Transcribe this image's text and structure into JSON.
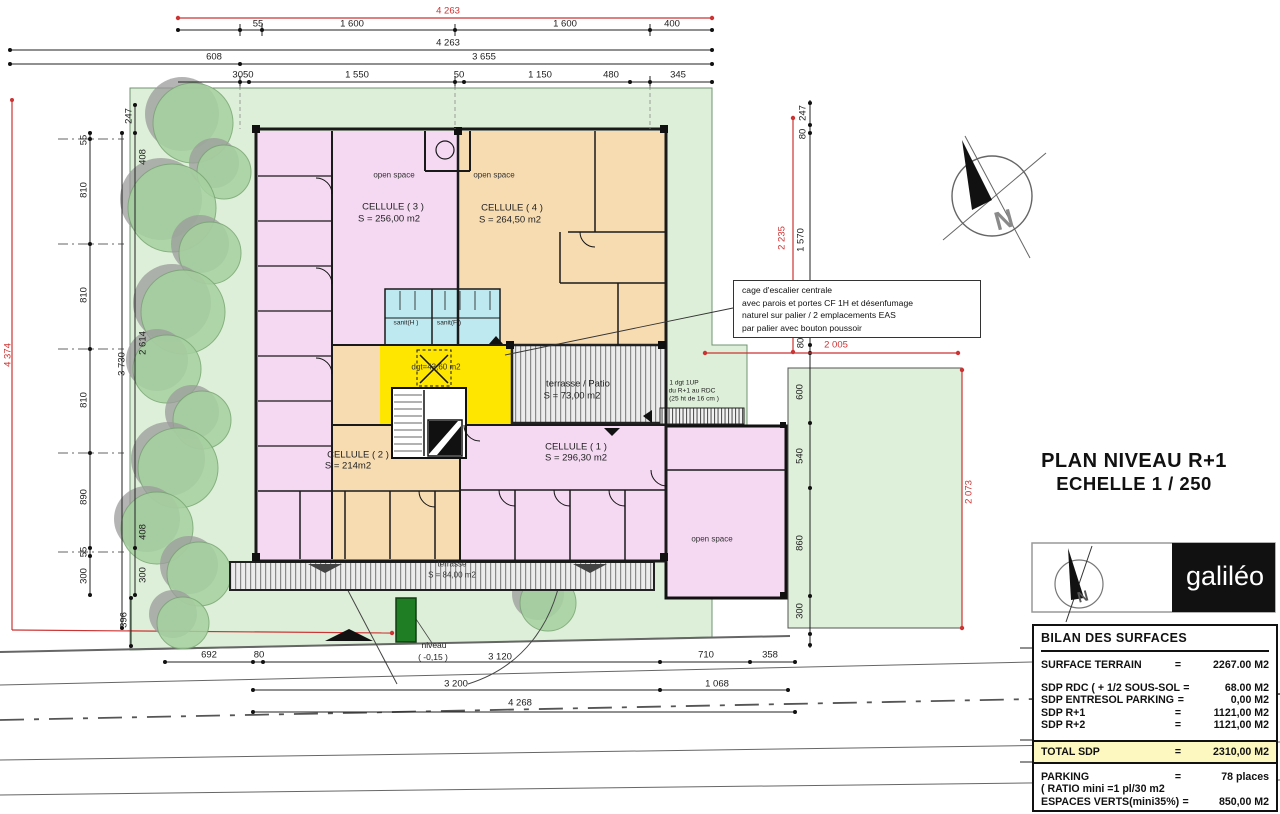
{
  "colors": {
    "accent_red": "#cc3333",
    "site_green": "#ddefd8",
    "room_pink": "#f5d9f3",
    "room_tan": "#f7dcb2",
    "room_cyan": "#bfe9f0",
    "room_yellow": "#ffe600",
    "table_total_bg": "#fcf8c0",
    "tree_green": "#a6d1a0",
    "planter_green": "#1f7d24"
  },
  "title_block": {
    "line1": "PLAN NIVEAU R+1",
    "line2": "ECHELLE  1 / 250"
  },
  "logo": {
    "brand": "galiléo"
  },
  "stair_note": {
    "lines": [
      "cage d'escalier centrale",
      "avec parois  et portes CF  1H et désenfumage",
      "naturel sur palier  / 2 emplacements EAS",
      "par palier avec bouton poussoir"
    ]
  },
  "surface_table": {
    "header": "BILAN DES SURFACES",
    "terrain": {
      "label": "SURFACE TERRAIN",
      "eq": "=",
      "value": "2267.00 M2"
    },
    "sdp_rows": [
      {
        "label": "SDP RDC ( + 1/2 SOUS-SOL",
        "eq": "=",
        "value": "68.00 M2"
      },
      {
        "label": "SDP ENTRESOL PARKING",
        "eq": "=",
        "value": "0,00 M2"
      },
      {
        "label": "SDP R+1",
        "eq": "=",
        "value": "1121,00 M2"
      },
      {
        "label": "SDP R+2",
        "eq": "=",
        "value": "1121,00 M2"
      }
    ],
    "total": {
      "label": "TOTAL SDP",
      "eq": "=",
      "value": "2310,00 M2"
    },
    "parking": {
      "label": "PARKING",
      "label2": "( RATIO mini =1 pl/30 m2",
      "eq": "=",
      "value": "78 places"
    },
    "espaces": {
      "label": "ESPACES VERTS(mini35%)",
      "eq": "=",
      "value": "850,00 M2"
    }
  },
  "labels": [
    {
      "t": "4 263",
      "x": 448,
      "y": 11,
      "c": "red",
      "n": "dim-top-total"
    },
    {
      "t": "55",
      "x": 258,
      "y": 24,
      "n": "dim"
    },
    {
      "t": "1 600",
      "x": 352,
      "y": 24,
      "n": "dim"
    },
    {
      "t": "1 600",
      "x": 565,
      "y": 24,
      "n": "dim"
    },
    {
      "t": "400",
      "x": 672,
      "y": 24,
      "n": "dim"
    },
    {
      "t": "4 263",
      "x": 448,
      "y": 43,
      "n": "dim"
    },
    {
      "t": "608",
      "x": 214,
      "y": 57,
      "n": "dim"
    },
    {
      "t": "3 655",
      "x": 484,
      "y": 57,
      "n": "dim"
    },
    {
      "t": "3050",
      "x": 243,
      "y": 75,
      "n": "dim"
    },
    {
      "t": "1 550",
      "x": 357,
      "y": 75,
      "n": "dim"
    },
    {
      "t": "50",
      "x": 459,
      "y": 75,
      "n": "dim"
    },
    {
      "t": "1 150",
      "x": 540,
      "y": 75,
      "n": "dim"
    },
    {
      "t": "480",
      "x": 611,
      "y": 75,
      "n": "dim"
    },
    {
      "t": "345",
      "x": 678,
      "y": 75,
      "n": "dim"
    },
    {
      "t": "4 374",
      "x": 8,
      "y": 355,
      "c": "red",
      "r": -90,
      "n": "dim-left-total"
    },
    {
      "t": "55",
      "x": 84,
      "y": 140,
      "r": -90,
      "n": "dim"
    },
    {
      "t": "810",
      "x": 84,
      "y": 190,
      "r": -90,
      "n": "dim"
    },
    {
      "t": "810",
      "x": 84,
      "y": 295,
      "r": -90,
      "n": "dim"
    },
    {
      "t": "810",
      "x": 84,
      "y": 400,
      "r": -90,
      "n": "dim"
    },
    {
      "t": "890",
      "x": 84,
      "y": 497,
      "r": -90,
      "n": "dim"
    },
    {
      "t": "55",
      "x": 84,
      "y": 552,
      "r": -90,
      "n": "dim"
    },
    {
      "t": "300",
      "x": 84,
      "y": 576,
      "r": -90,
      "n": "dim"
    },
    {
      "t": "247",
      "x": 129,
      "y": 116,
      "r": -90,
      "n": "dim"
    },
    {
      "t": "408",
      "x": 143,
      "y": 157,
      "r": -90,
      "n": "dim"
    },
    {
      "t": "2 614",
      "x": 143,
      "y": 343,
      "r": -90,
      "n": "dim"
    },
    {
      "t": "3 730",
      "x": 122,
      "y": 364,
      "r": -90,
      "n": "dim"
    },
    {
      "t": "408",
      "x": 143,
      "y": 532,
      "r": -90,
      "n": "dim"
    },
    {
      "t": "300",
      "x": 143,
      "y": 575,
      "r": -90,
      "n": "dim"
    },
    {
      "t": "396",
      "x": 124,
      "y": 620,
      "r": -90,
      "n": "dim"
    },
    {
      "t": "247",
      "x": 803,
      "y": 113,
      "r": -90,
      "n": "dim"
    },
    {
      "t": "80",
      "x": 803,
      "y": 134,
      "r": -90,
      "n": "dim"
    },
    {
      "t": "2 235",
      "x": 782,
      "y": 238,
      "c": "red",
      "r": -90,
      "n": "dim"
    },
    {
      "t": "1 570",
      "x": 801,
      "y": 240,
      "r": -90,
      "n": "dim"
    },
    {
      "t": "80",
      "x": 801,
      "y": 343,
      "r": -90,
      "n": "dim"
    },
    {
      "t": "2 005",
      "x": 836,
      "y": 345,
      "c": "red",
      "n": "dim"
    },
    {
      "t": "600",
      "x": 800,
      "y": 392,
      "r": -90,
      "n": "dim"
    },
    {
      "t": "540",
      "x": 800,
      "y": 456,
      "r": -90,
      "n": "dim"
    },
    {
      "t": "860",
      "x": 800,
      "y": 543,
      "r": -90,
      "n": "dim"
    },
    {
      "t": "300",
      "x": 800,
      "y": 611,
      "r": -90,
      "n": "dim"
    },
    {
      "t": "2 073",
      "x": 969,
      "y": 492,
      "c": "red",
      "r": -90,
      "n": "dim"
    },
    {
      "t": "692",
      "x": 209,
      "y": 655,
      "n": "dim"
    },
    {
      "t": "80",
      "x": 259,
      "y": 655,
      "n": "dim"
    },
    {
      "t": "niveau",
      "x": 434,
      "y": 645,
      "c": "sm",
      "n": "level-note"
    },
    {
      "t": "( -0,15 )",
      "x": 433,
      "y": 657,
      "c": "sm",
      "n": "level-note"
    },
    {
      "t": "3 120",
      "x": 500,
      "y": 657,
      "n": "dim"
    },
    {
      "t": "710",
      "x": 706,
      "y": 655,
      "n": "dim"
    },
    {
      "t": "358",
      "x": 770,
      "y": 655,
      "n": "dim"
    },
    {
      "t": "3 200",
      "x": 456,
      "y": 684,
      "n": "dim"
    },
    {
      "t": "1 068",
      "x": 717,
      "y": 684,
      "n": "dim"
    },
    {
      "t": "4 268",
      "x": 520,
      "y": 703,
      "n": "dim"
    },
    {
      "t": "open space",
      "x": 394,
      "y": 175,
      "c": "rm-s",
      "n": "room-open-space-3"
    },
    {
      "t": "CELLULE ( 3 )",
      "x": 393,
      "y": 207,
      "c": "rm",
      "n": "room-cellule-3"
    },
    {
      "t": "S = 256,00 m2",
      "x": 389,
      "y": 219,
      "c": "rm",
      "n": "room-cellule-3-area"
    },
    {
      "t": "open space",
      "x": 494,
      "y": 175,
      "c": "rm-s",
      "n": "room-open-space-4"
    },
    {
      "t": "CELLULE ( 4 )",
      "x": 512,
      "y": 208,
      "c": "rm",
      "n": "room-cellule-4"
    },
    {
      "t": "S = 264,50 m2",
      "x": 510,
      "y": 220,
      "c": "rm",
      "n": "room-cellule-4-area"
    },
    {
      "t": "sanit(H )",
      "x": 406,
      "y": 323,
      "c": "xs",
      "n": "room-sanit-h"
    },
    {
      "t": "sanit(F )",
      "x": 449,
      "y": 323,
      "c": "xs",
      "n": "room-sanit-f"
    },
    {
      "t": "dgt=43,60 m2",
      "x": 436,
      "y": 367,
      "c": "rm-s",
      "n": "room-dgt"
    },
    {
      "t": "terrasse /  Patio",
      "x": 578,
      "y": 384,
      "c": "rm",
      "n": "room-terrasse-patio"
    },
    {
      "t": "S = 73,00 m2",
      "x": 572,
      "y": 396,
      "c": "rm",
      "n": "room-terrasse-patio-area"
    },
    {
      "t": "1 dgt 1UP",
      "x": 684,
      "y": 383,
      "c": "xs",
      "n": "note-dgt-1up"
    },
    {
      "t": "du R+1 au RDC",
      "x": 692,
      "y": 391,
      "c": "xs",
      "n": "note-dgt-1up"
    },
    {
      "t": "(25 ht de 16 cm )",
      "x": 694,
      "y": 399,
      "c": "xs",
      "n": "note-dgt-1up"
    },
    {
      "t": "CELLULE ( 2 )",
      "x": 358,
      "y": 455,
      "c": "rm",
      "n": "room-cellule-2"
    },
    {
      "t": "S = 214m2",
      "x": 348,
      "y": 466,
      "c": "rm",
      "n": "room-cellule-2-area"
    },
    {
      "t": "CELLULE ( 1 )",
      "x": 576,
      "y": 447,
      "c": "rm",
      "n": "room-cellule-1"
    },
    {
      "t": "S = 296,30 m2",
      "x": 576,
      "y": 458,
      "c": "rm",
      "n": "room-cellule-1-area"
    },
    {
      "t": "open space",
      "x": 712,
      "y": 539,
      "c": "rm-s",
      "n": "room-open-space-1"
    },
    {
      "t": "terrasse",
      "x": 452,
      "y": 564,
      "c": "rm-s",
      "n": "room-terrasse"
    },
    {
      "t": "S = 84,00 m2",
      "x": 452,
      "y": 575,
      "c": "rm-s",
      "n": "room-terrasse-area"
    },
    {
      "t": "N",
      "x": 1004,
      "y": 220,
      "c": "compass-n",
      "r": -15,
      "n": "north-letter"
    },
    {
      "t": "N",
      "x": 1083,
      "y": 597,
      "c": "logo-n",
      "r": -15,
      "n": "logo-north-letter"
    }
  ]
}
